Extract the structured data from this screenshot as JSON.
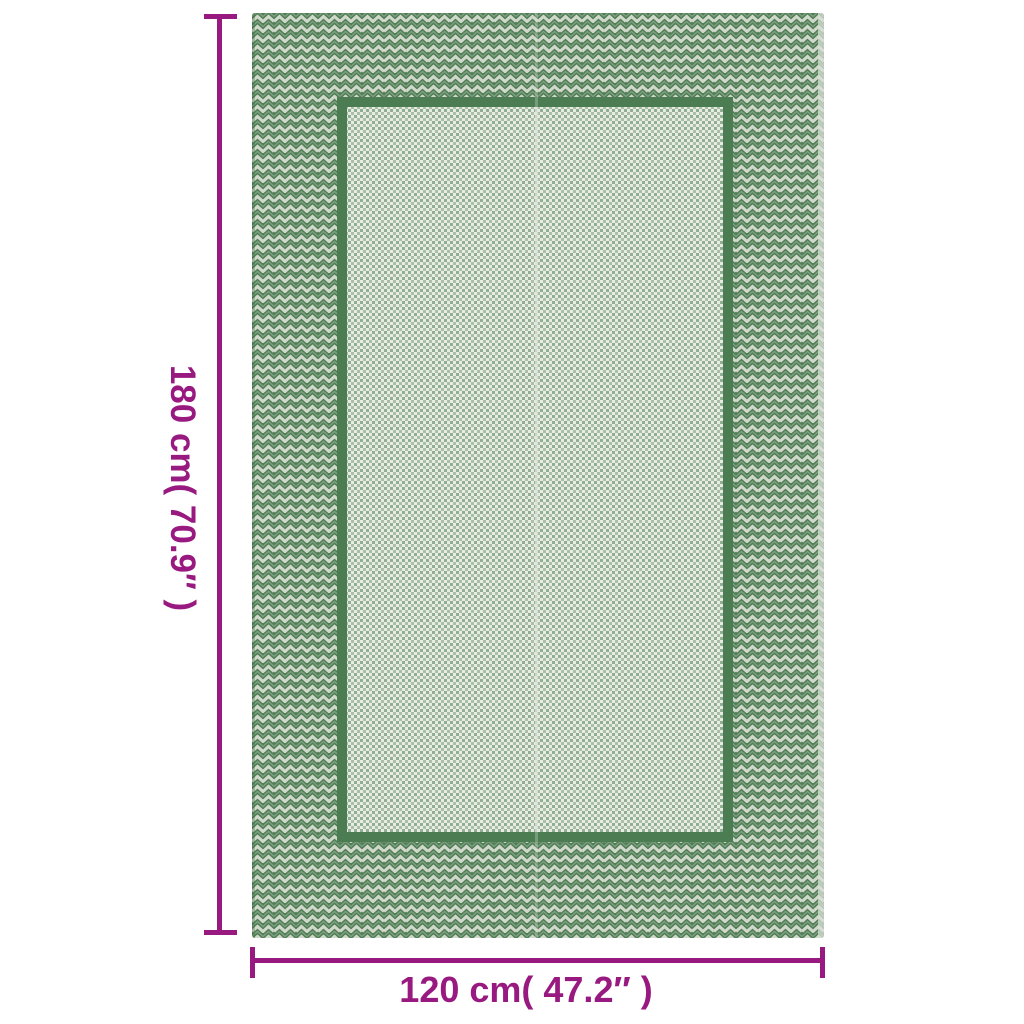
{
  "canvas": {
    "width": 1024,
    "height": 1024,
    "background": "#ffffff"
  },
  "annotation": {
    "accent_color": "#98197f",
    "height_label": "180 cm( 70.9″ )",
    "width_label": "120 cm( 47.2″ )"
  },
  "rug": {
    "kind": "green outdoor rug product photo",
    "border_pattern": "chevron-zigzag",
    "field_pattern": "fine-checker-weave",
    "border_green": "#4e7d53",
    "border_light": "#cfd8ca",
    "border_mid": "#7f9f82",
    "frame_green": "#4c7c52",
    "field_light": "#e9ece3",
    "field_green": "#8fae94",
    "field_green2": "#a9bfa8",
    "seam_color": "#dde3d8",
    "selvage_color": "#d9dfd4",
    "edge_shadow": "#3f6b46"
  }
}
